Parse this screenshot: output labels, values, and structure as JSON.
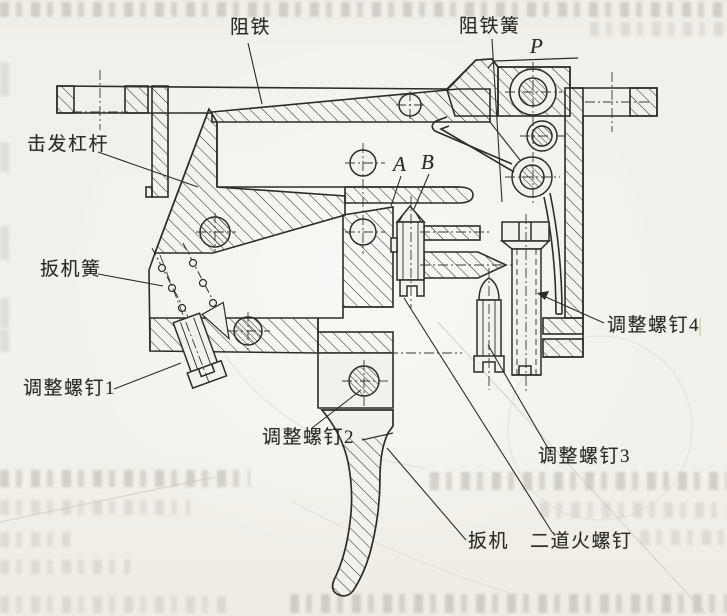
{
  "figure": {
    "type": "technical-sectional-drawing",
    "subject": "trigger mechanism cross-section (scanned book figure)",
    "colors": {
      "paper": "#f3f1eb",
      "ink": "#2e2c26",
      "ghost": "#c9c4b8"
    },
    "labels": [
      {
        "id": "sear",
        "text": "阻铁"
      },
      {
        "id": "sear-spring",
        "text": "阻铁簧"
      },
      {
        "id": "force-p",
        "text": "P"
      },
      {
        "id": "firing-lever",
        "text": "击发杠杆"
      },
      {
        "id": "point-a",
        "text": "A"
      },
      {
        "id": "point-b",
        "text": "B"
      },
      {
        "id": "trigger-spring",
        "text": "扳机簧"
      },
      {
        "id": "adjust-screw-1",
        "text": "调整螺钉1"
      },
      {
        "id": "adjust-screw-2",
        "text": "调整螺钉2"
      },
      {
        "id": "adjust-screw-3",
        "text": "调整螺钉3"
      },
      {
        "id": "adjust-screw-4",
        "text": "调整螺钉4"
      },
      {
        "id": "trigger",
        "text": "扳机"
      },
      {
        "id": "second-stage-screw",
        "text": "二道火螺钉"
      }
    ]
  }
}
